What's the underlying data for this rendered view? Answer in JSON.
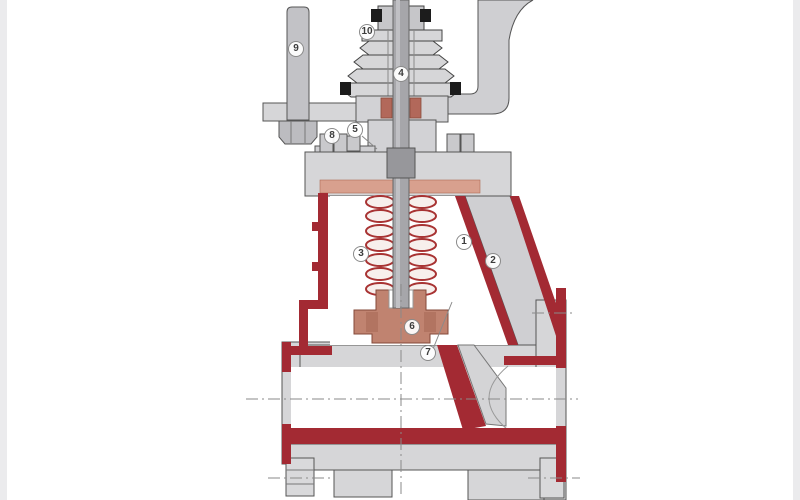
{
  "diagram": {
    "type": "valve-cross-section",
    "description": "Sectioned bellows-seal globe valve technical illustration with numbered part callouts",
    "callouts": [
      {
        "label": "1",
        "x": 464,
        "y": 242
      },
      {
        "label": "2",
        "x": 493,
        "y": 261
      },
      {
        "label": "3",
        "x": 361,
        "y": 254
      },
      {
        "label": "4",
        "x": 401,
        "y": 74
      },
      {
        "label": "5",
        "x": 355,
        "y": 130
      },
      {
        "label": "6",
        "x": 412,
        "y": 327
      },
      {
        "label": "7",
        "x": 428,
        "y": 353
      },
      {
        "label": "8",
        "x": 332,
        "y": 136
      },
      {
        "label": "9",
        "x": 296,
        "y": 49
      },
      {
        "label": "10",
        "x": 367,
        "y": 32
      }
    ],
    "colors": {
      "background": "#ffffff",
      "body_gray": "#d6d6d8",
      "mid_gray": "#c6c6c9",
      "stem_gray": "#a6a6aa",
      "section_red": "#a32a33",
      "disc_salmon": "#c08370",
      "gasket_salmon": "#d8a08e",
      "seal_black": "#1c1c1c",
      "outline": "#555555",
      "centerline_gray": "#8a8a8a"
    }
  }
}
